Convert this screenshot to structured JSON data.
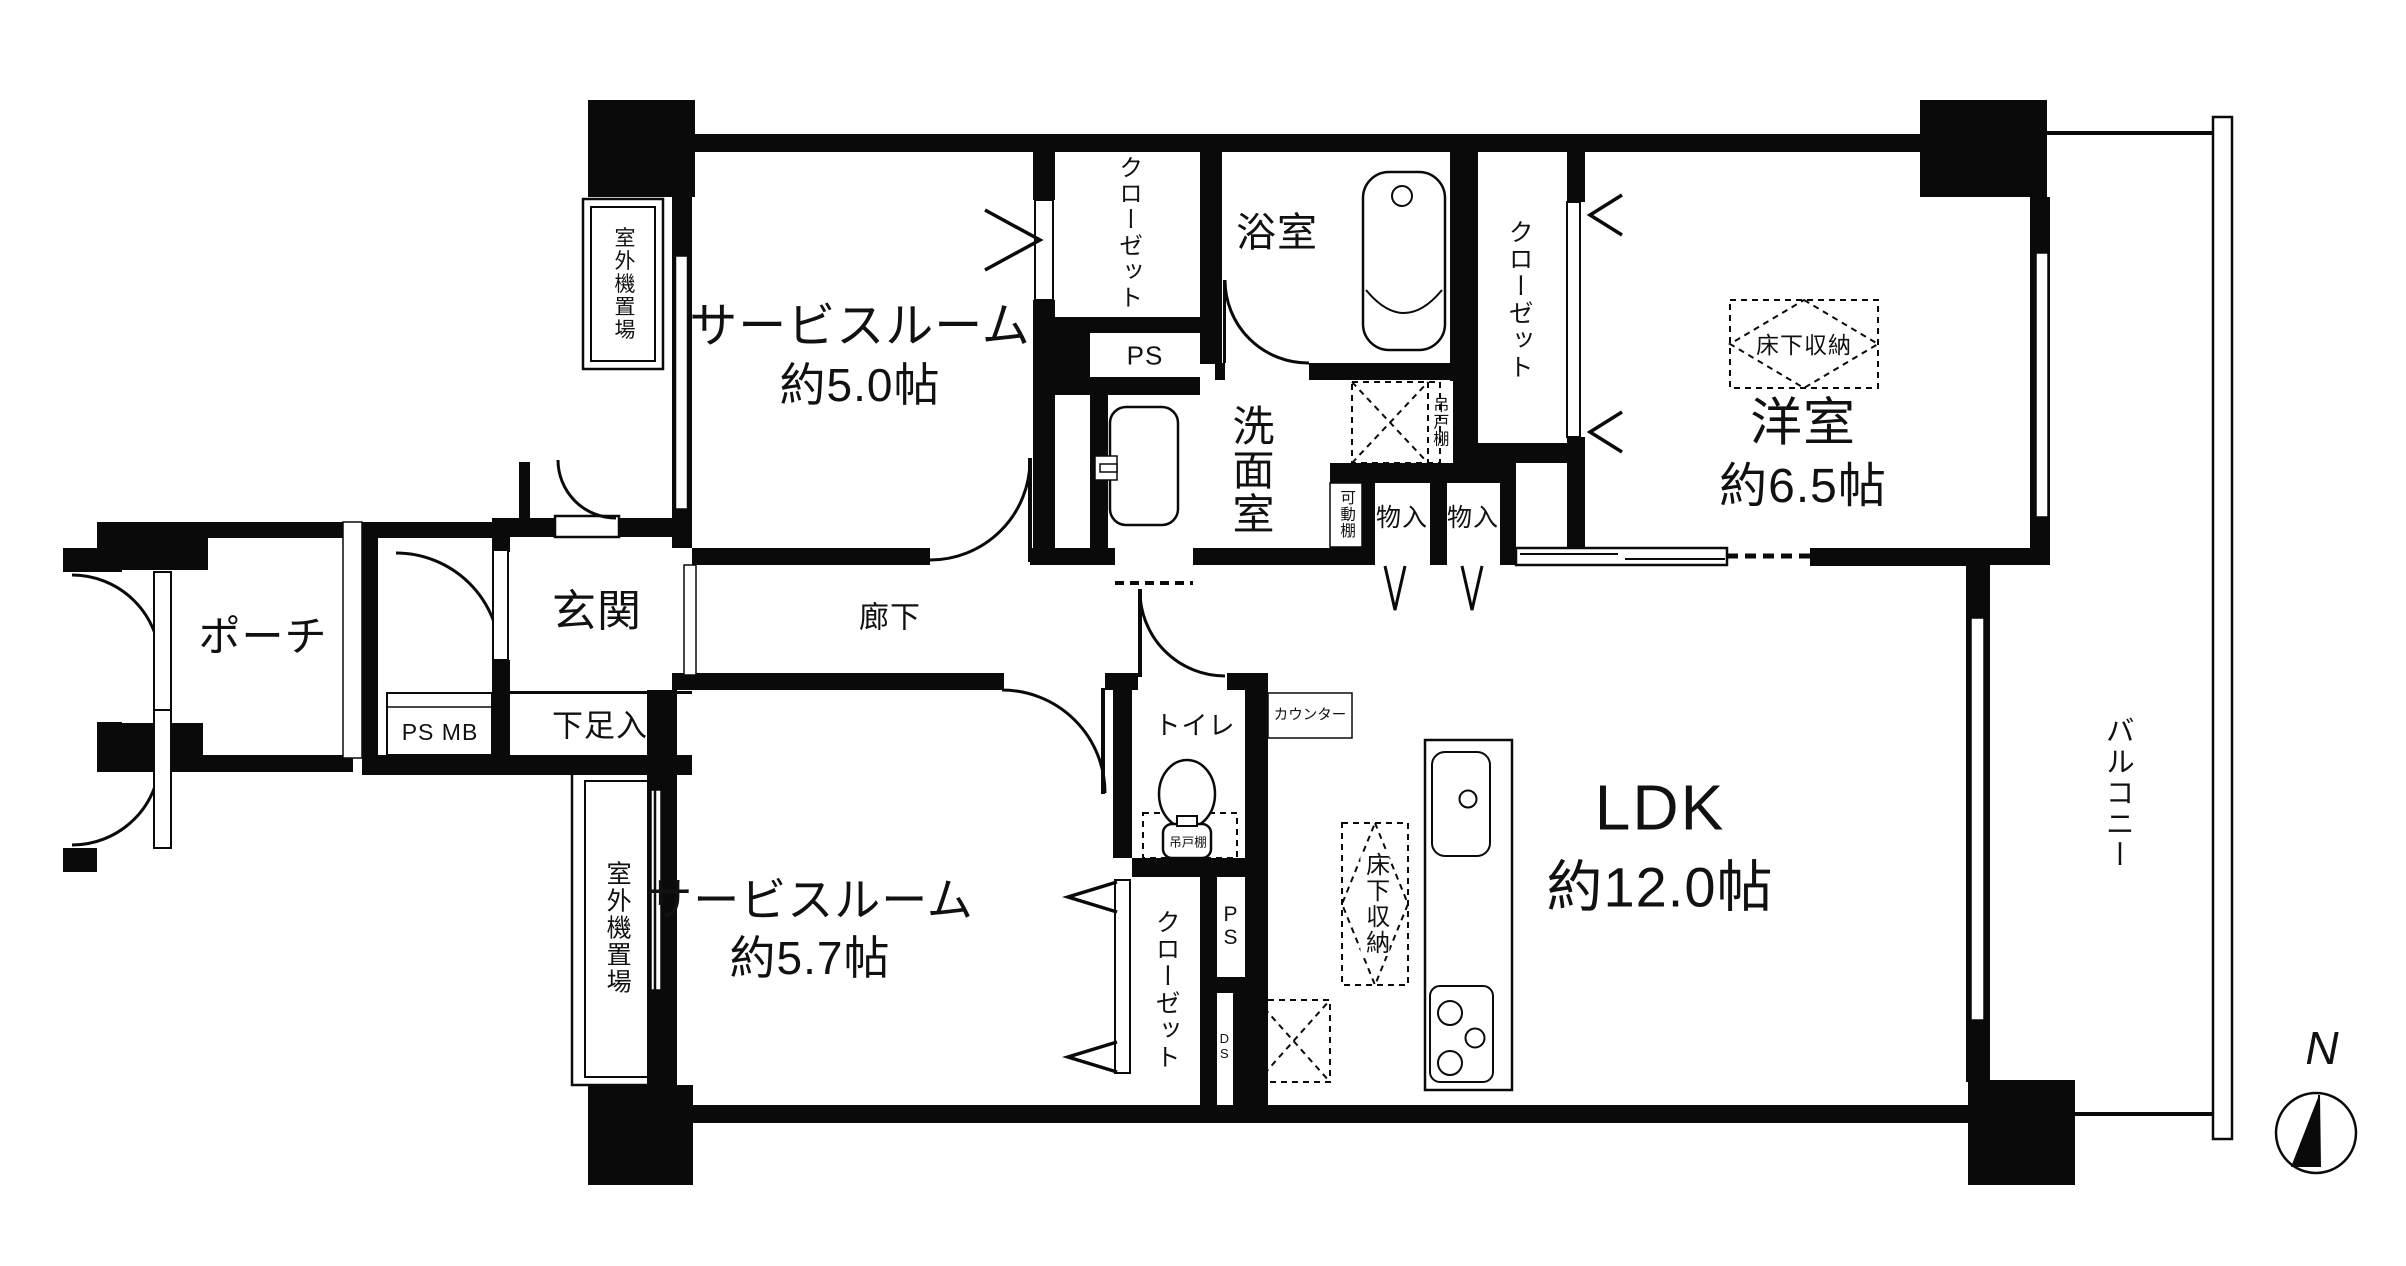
{
  "rooms": {
    "service_room_1_name": "サービスルーム",
    "service_room_1_size": "約5.0帖",
    "service_room_2_name": "サービスルーム",
    "service_room_2_size": "約5.7帖",
    "western_room_name": "洋室",
    "western_room_size": "約6.5帖",
    "ldk_name": "LDK",
    "ldk_size": "約12.0帖",
    "bathroom": "浴室",
    "washroom": "洗面室",
    "toilet": "トイレ",
    "hallway": "廊下",
    "entrance": "玄関",
    "porch": "ポーチ",
    "balcony": "バルコニー"
  },
  "storage": {
    "closet_nw": "クローゼット",
    "closet_west_room": "クローゼット",
    "closet_south": "クローゼット",
    "shoe_cabinet": "下足入",
    "storage_1": "物入",
    "storage_2": "物入",
    "underfloor_west_room": "床下収納",
    "underfloor_kitchen": "床下収納",
    "hanging_cupboard_washroom": "吊戸棚",
    "hanging_cupboard_toilet": "吊戸棚",
    "movable_shelf": "可動棚",
    "counter": "カウンター"
  },
  "utility": {
    "ps_mb": "PS MB",
    "ps_north": "PS",
    "ps_south": "PS",
    "ds": "DS"
  },
  "outdoor": {
    "ac_unit_north": "室外機置場",
    "ac_unit_south": "室外機置場"
  },
  "compass": {
    "north_label": "N"
  }
}
